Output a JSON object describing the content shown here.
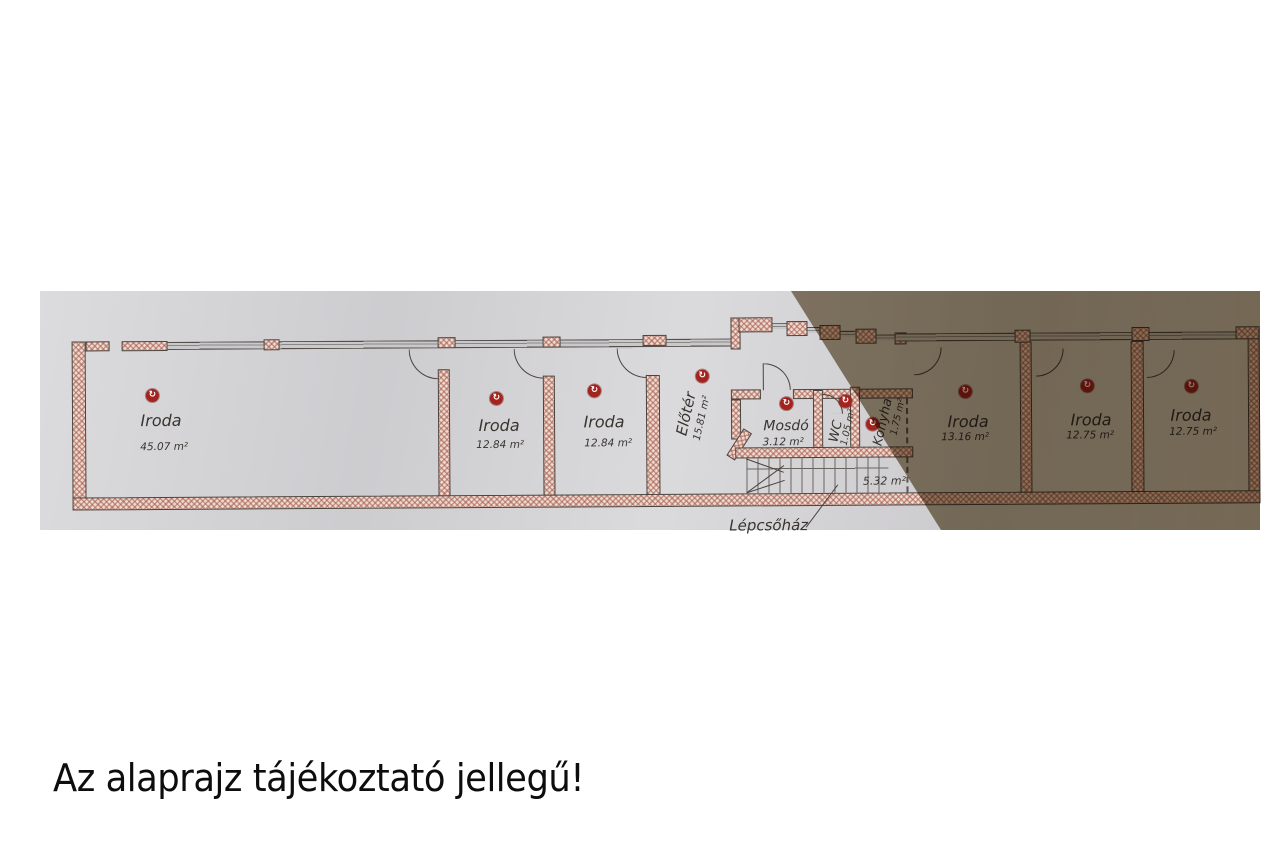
{
  "caption": "Az alaprajz tájékoztató jellegű!",
  "plan": {
    "marker_glyph": "↻",
    "rooms": [
      {
        "name": "Iroda",
        "area": "45.07 m²"
      },
      {
        "name": "Iroda",
        "area": "12.84 m²"
      },
      {
        "name": "Iroda",
        "area": "12.84 m²"
      },
      {
        "name": "Előtér",
        "area": "15.81 m²"
      },
      {
        "name": "Mosdó",
        "area": "3.12 m²"
      },
      {
        "name": "WC",
        "area": "1.05 m²"
      },
      {
        "name": "Konyha",
        "area": "1.75 m²"
      },
      {
        "name": "Iroda",
        "area": "13.16 m²"
      },
      {
        "name": "Iroda",
        "area": "12.75 m²"
      },
      {
        "name": "Iroda",
        "area": "12.75 m²"
      }
    ],
    "stairs": {
      "label": "Lépcsőház",
      "area": "5.32 m²"
    }
  },
  "colors": {
    "paper": "#d6d5d8",
    "paper_shadow": "#8e8276",
    "wall_fill": "#eed9cf",
    "wall_hatch": "#a55a4e",
    "plan_line": "#4a443e",
    "marker_red": "#a5231f",
    "text": "#38342f",
    "caption_text": "#0d0d0d"
  }
}
